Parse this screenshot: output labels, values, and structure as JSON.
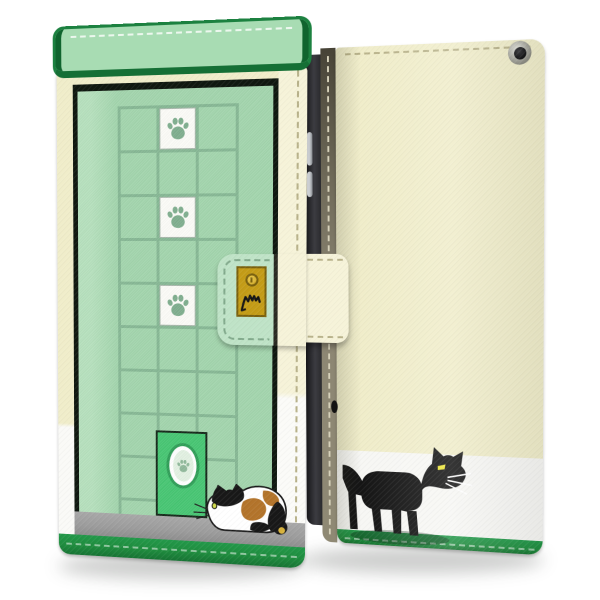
{
  "scene": {
    "type": "product-photo",
    "subject": "cat-themed green flip wallet smartphone case shown in two views",
    "views": [
      "front-cover-closed",
      "back-cover"
    ]
  },
  "colors": {
    "page_bg": "#ffffff",
    "band_green": "#a8dcb3",
    "band_edge": "#1c8140",
    "panel_green": "#a3d5ad",
    "grid_line": "#86b794",
    "paw": "#7fae8e",
    "tile_white": "#fbfbf7",
    "door_green": "#47c673",
    "cream": "#f0edca",
    "white_band": "#f7f7f4",
    "floor_gray": "#9c9c9c",
    "bottom_green": "#1f8c3e",
    "spine_taupe": "#8c8673",
    "phone_dark": "#28282b",
    "gold": "#c49c17",
    "calico_orange": "#b3742b",
    "cat_black": "#161616",
    "eye_yellow": "#ece53a"
  },
  "front_view": {
    "paw_tile_count": 3,
    "grid": {
      "columns": 3,
      "visible_rows": 9
    },
    "pet_door_ornament": "paw-print-in-oval",
    "cat": "calico-cat-crouching",
    "clasp_charm": "gold-square-with-black-cat-scribble",
    "snap": "round-snap-button"
  },
  "back_view": {
    "camera_hole": 1,
    "strap_hole": 1,
    "cat": "black-cat-walking",
    "bands_top_to_bottom": [
      "cream",
      "white",
      "green"
    ],
    "side_buttons": 2
  }
}
